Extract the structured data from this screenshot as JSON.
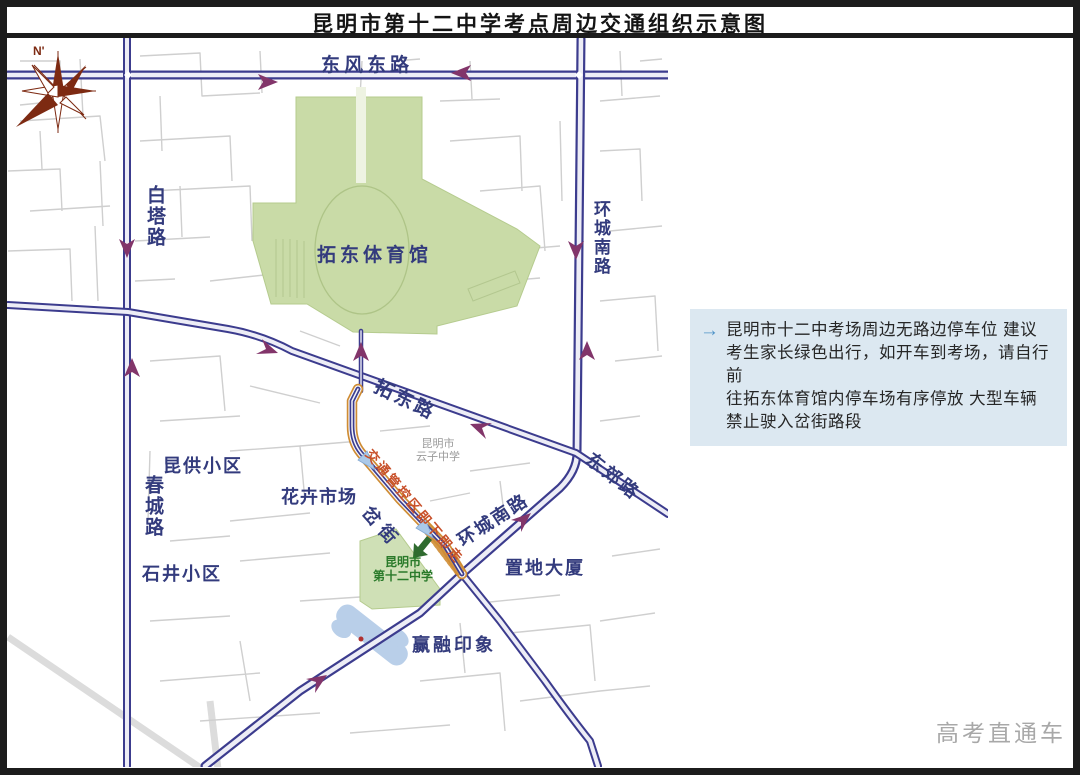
{
  "title": "昆明市第十二中学考点周边交通组织示意图",
  "compass": {
    "label": "N'"
  },
  "map": {
    "labels": {
      "dongfeng_east_rd": "东风东路",
      "baita_rd": "白塔路",
      "huancheng_south_rd_north": "环城南路",
      "tuodong_stadium": "拓东体育馆",
      "tuodong_rd": "拓东路",
      "dongjiao_rd": "东郊路",
      "huancheng_south_rd_sw": "环城南路",
      "kungong_residential": "昆供小区",
      "chuncheng_rd": "春城路",
      "flower_market": "花卉市场",
      "shijing_residential": "石井小区",
      "cha_street": "岔街",
      "yunzi_school_line1": "昆明市",
      "yunzi_school_line2": "云子中学",
      "exam_school_line1": "昆明市",
      "exam_school_line2": "第十二中学",
      "zhidi_building": "置地大厦",
      "yingrong_impression": "赢融印象",
      "control_zone_note": "交通管控区即下即走"
    },
    "colors": {
      "road": "#3c3c8e",
      "road_fill": "#ededf6",
      "arrow_purple": "#82356a",
      "control_road_orange": "#cf8c33",
      "control_text_orange": "#c8502a",
      "green_area": "#c9dba7",
      "school_green_text": "#2a7a2a",
      "bridge_blue": "#b9cfe9",
      "label_navy": "#333b7d",
      "bg_street_gray": "#cfcfcf"
    }
  },
  "advisory": {
    "arrow_icon": "→",
    "lines": [
      "昆明市十二中考场周边无路边停车位  建议",
      "考生家长绿色出行，如开车到考场，请自行前",
      "往拓东体育馆内停车场有序停放  大型车辆",
      "禁止驶入岔街路段"
    ]
  },
  "footer": {
    "watermark": "高考直通车"
  }
}
